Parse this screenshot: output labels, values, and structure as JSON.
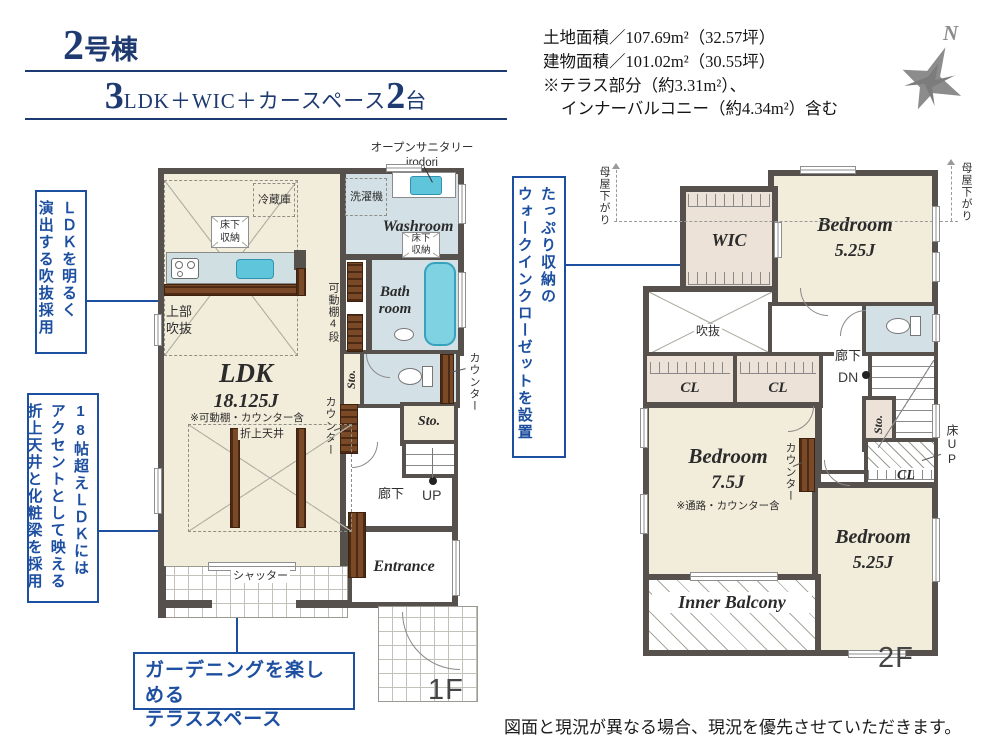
{
  "header": {
    "building": "2号棟",
    "layout_num1": "3",
    "layout_mid": "LDK＋WIC＋カースペース",
    "layout_num2": "2",
    "layout_tail": "台",
    "area1": "土地面積／107.69m²（32.57坪）",
    "area2": "建物面積／101.02m²（30.55坪）",
    "area3": "※テラス部分（約3.31m²）、",
    "area4": "インナーバルコニー（約4.34m²）含む",
    "compass_n": "N"
  },
  "callouts": {
    "void": {
      "col1": "ＬＤＫを明るく",
      "col2": "演出する吹抜採用"
    },
    "ceiling": {
      "col1": "18帖超えＬＤＫには",
      "col2": "アクセントとして映える",
      "col3": "折上天井と化粧梁を採用"
    },
    "terrace": {
      "line1": "ガーデニングを楽しめる",
      "line2": "テラススペース"
    },
    "wic": {
      "col1": "たっぷり収納の",
      "col2": "ウォークインクローゼットを設置"
    }
  },
  "floor1": {
    "label": "1F",
    "ldk_name": "LDK",
    "ldk_size": "18.125J",
    "ldk_note": "※可動棚・カウンター含",
    "washroom": "Washroom",
    "bath1": "Bath",
    "bath2": "room",
    "entrance": "Entrance",
    "sto_small": "Sto.",
    "sto_room": "Sto.",
    "refrigerator": "冷蔵庫",
    "underfloor_ldk": "床下収納",
    "underfloor_wash": "床下収納",
    "washer": "洗濯機",
    "sanitary1": "オープンサニタリー",
    "sanitary2": "irodori",
    "upper_void": "上部吹抜",
    "shelf": "可動棚4段",
    "counter_right": "カウンター",
    "counter_left": "カウンター",
    "coffered": "折上天井",
    "shutter": "シャッター",
    "corridor": "廊下",
    "up": "UP"
  },
  "floor2": {
    "label": "2F",
    "wic": "WIC",
    "bed1_name": "Bedroom",
    "bed1_size": "5.25J",
    "bed2_name": "Bedroom",
    "bed2_size": "7.5J",
    "bed2_note": "※通路・カウンター含",
    "bed3_name": "Bedroom",
    "bed3_size": "5.25J",
    "balcony": "Inner Balcony",
    "cl1": "CL",
    "cl2": "CL",
    "cl3": "CL",
    "sto": "Sto.",
    "void": "吹抜",
    "corridor": "廊下",
    "dn": "DN",
    "counter": "カウンター",
    "floor_up": "床UP",
    "moya_left": "母屋下がり",
    "moya_right": "母屋下がり"
  },
  "footer": {
    "disclaimer": "図面と現況が異なる場合、現況を優先させていただきます。"
  }
}
